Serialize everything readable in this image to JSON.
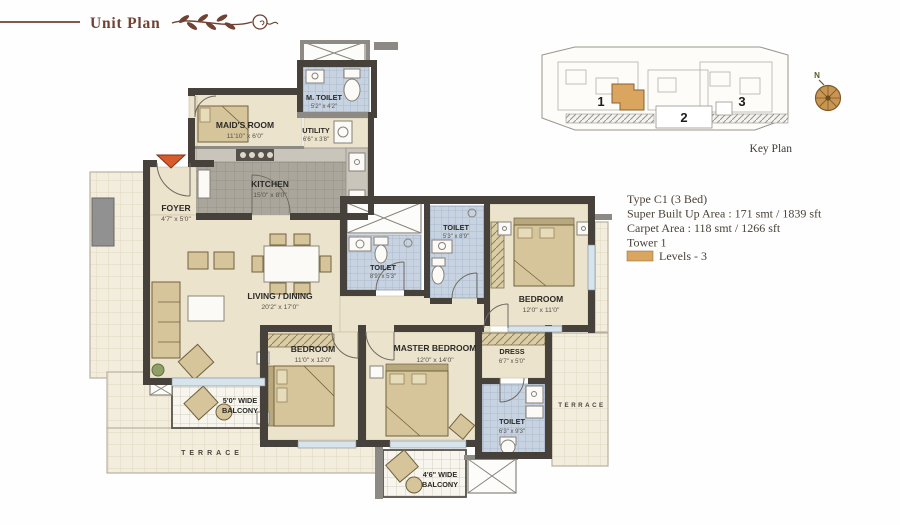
{
  "header": {
    "title": "Unit Plan"
  },
  "key_plan": {
    "caption": "Key Plan",
    "tower_labels": [
      "1",
      "2",
      "3"
    ]
  },
  "compass": {
    "north": "N"
  },
  "unit_info": {
    "type": "Type C1 (3 Bed)",
    "super_built_up": "Super Built Up Area : 171 smt / 1839 sft",
    "carpet_area": "Carpet Area : 118 smt / 1266 sft",
    "tower": "Tower 1",
    "levels": "Levels - 3"
  },
  "rooms": {
    "maids_room": {
      "name": "MAID'S ROOM",
      "dim": "11'10\" x 6'0\""
    },
    "m_toilet": {
      "name": "M. TOILET",
      "dim": "5'2\" x 4'2\""
    },
    "utility": {
      "name": "UTILITY",
      "dim": "6'6\" x 3'8\""
    },
    "kitchen": {
      "name": "KITCHEN",
      "dim": "15'0\" x 8'0\""
    },
    "foyer": {
      "name": "FOYER",
      "dim": "4'7\" x 5'0\""
    },
    "living_dining": {
      "name": "LIVING / DINING",
      "dim": "20'2\" x 17'0\""
    },
    "toilet_common": {
      "name": "TOILET",
      "dim": "8'9\" x 5'3\""
    },
    "toilet_guest": {
      "name": "TOILET",
      "dim": "5'3\" x 8'9\""
    },
    "bedroom_right": {
      "name": "BEDROOM",
      "dim": "12'0\" x 11'0\""
    },
    "bedroom_left": {
      "name": "BEDROOM",
      "dim": "11'0\" x 12'0\""
    },
    "master_bedroom": {
      "name": "MASTER BEDROOM",
      "dim": "12'0\" x 14'0\""
    },
    "dress": {
      "name": "DRESS",
      "dim": "6'7\" x 5'0\""
    },
    "toilet_master": {
      "name": "TOILET",
      "dim": "6'3\" x 9'3\""
    },
    "balcony_left": {
      "line1": "5'0\" WIDE",
      "line2": "BALCONY"
    },
    "balcony_bottom": {
      "line1": "4'6\" WIDE",
      "line2": "BALCONY"
    },
    "terrace_left": "TERRACE",
    "terrace_right": "TERRACE"
  },
  "colors": {
    "brand": "#6f4232",
    "accent": "#d9a55f",
    "wall": "#46423b",
    "wall2": "#8d8a85",
    "cream": "#ece3cc",
    "furn": "#d6c49a",
    "ink": "#4a4237",
    "terrline": "#b9b1a0"
  }
}
